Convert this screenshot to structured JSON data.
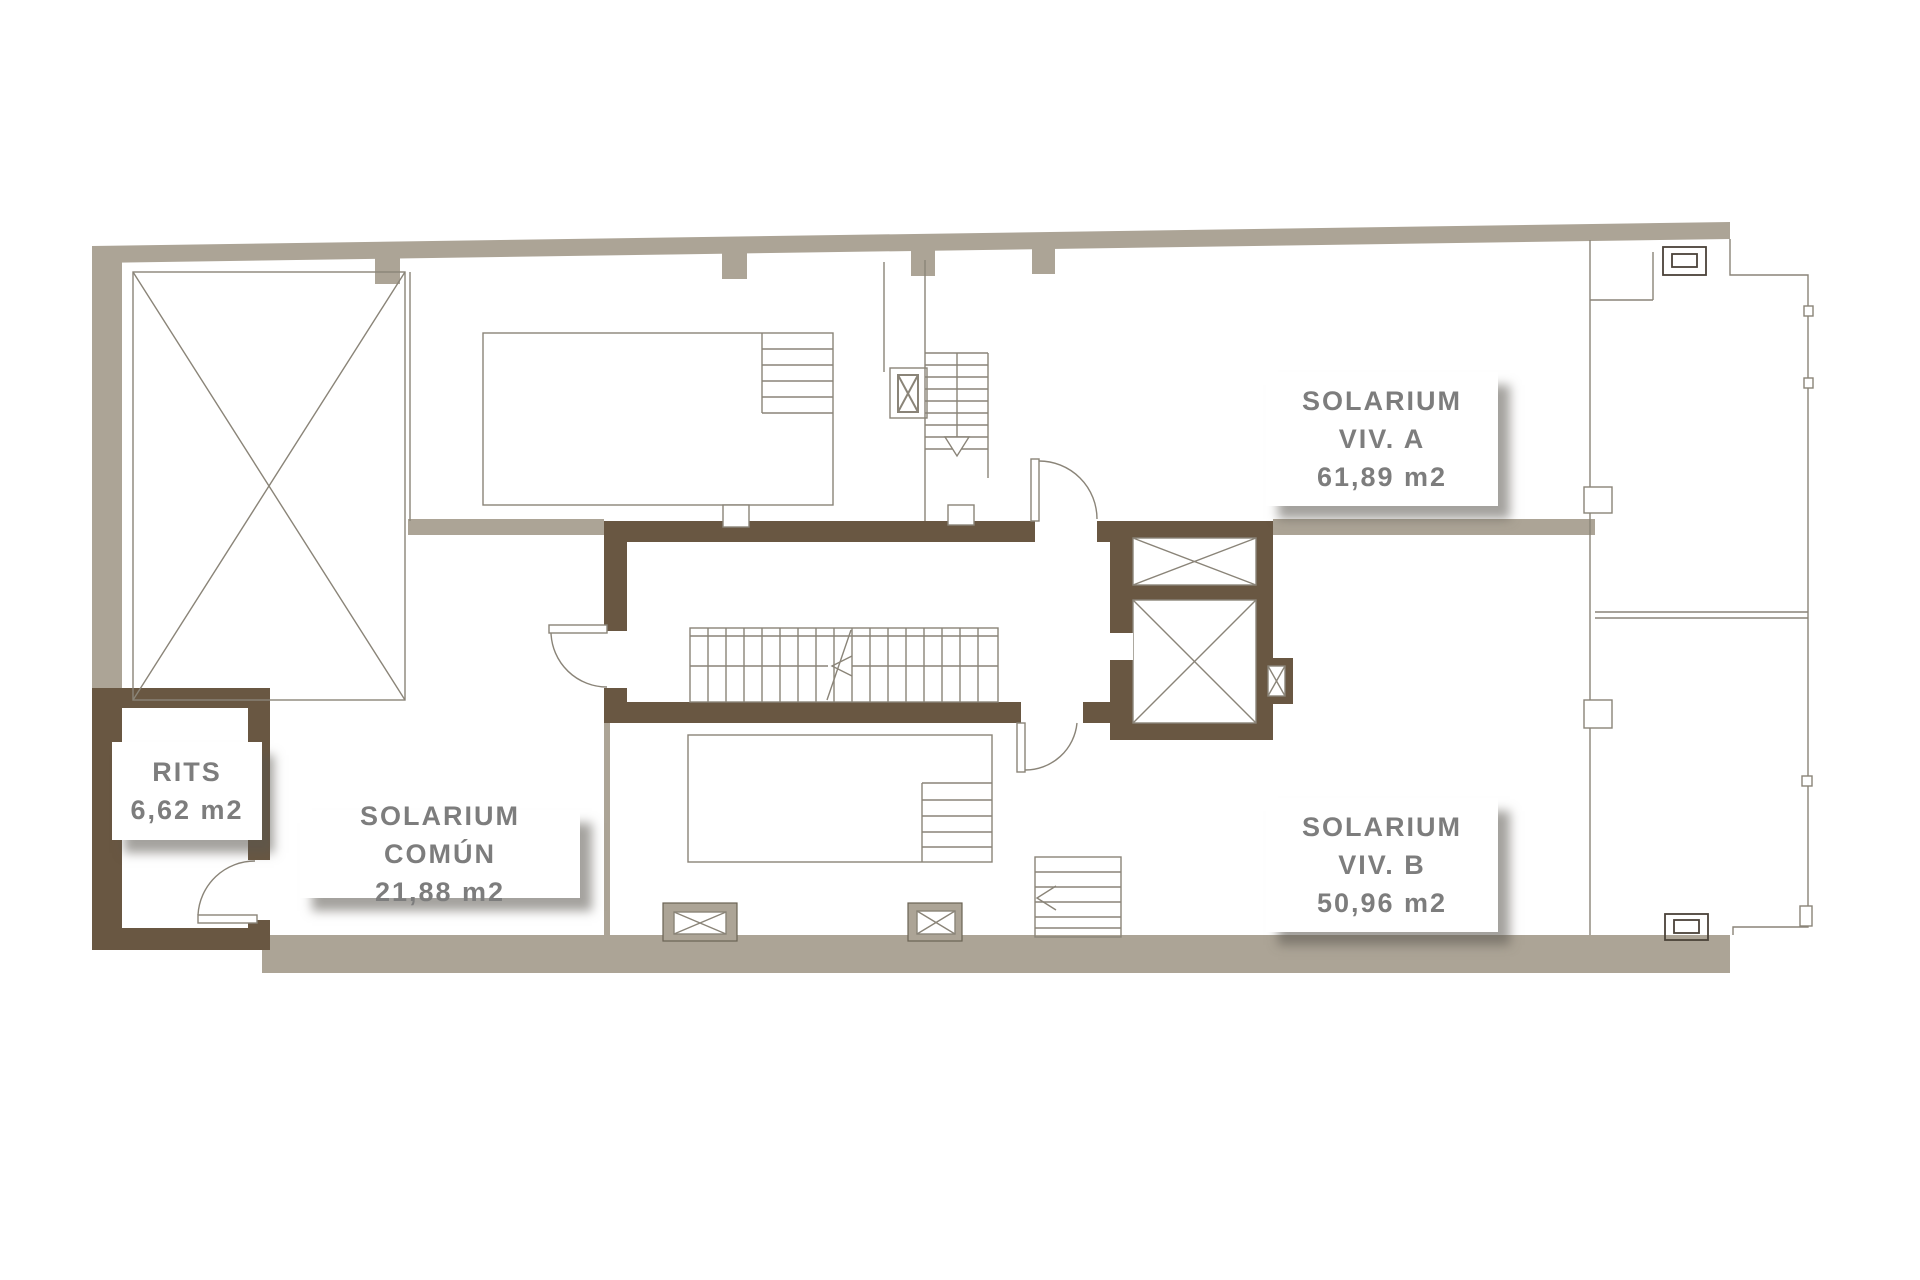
{
  "colors": {
    "wall_tan": "#aca496",
    "wall_dark": "#695742",
    "line": "#8a8478",
    "line_dark": "#5f5242",
    "label_text": "#7d7d7d",
    "label_bg": "#ffffff"
  },
  "labels": {
    "solarium_viv_a": {
      "line1": "SOLARIUM",
      "line2": "VIV. A",
      "line3": "61,89 m2"
    },
    "solarium_viv_b": {
      "line1": "SOLARIUM",
      "line2": "VIV. B",
      "line3": "50,96 m2"
    },
    "solarium_comun": {
      "line1": "SOLARIUM COMÚN",
      "line2": "21,88 m2"
    },
    "rits": {
      "line1": "RITS",
      "line2": "6,62 m2"
    }
  }
}
